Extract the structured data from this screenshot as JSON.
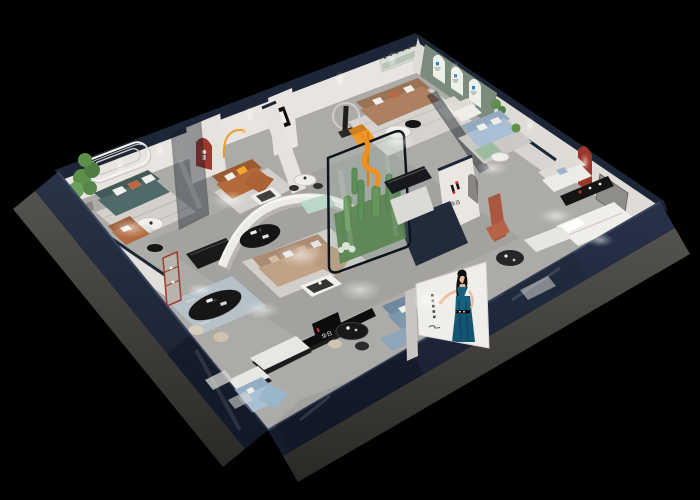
{
  "scene": {
    "type": "3d-isometric-cutaway-render",
    "setting": "furniture brand showroom interior at night on black background",
    "background_color": "#000000"
  },
  "brand": {
    "logo_mark": "stylized-H-black-red",
    "logo_text": "华日",
    "logo_black": "#151515",
    "logo_red": "#c92a26",
    "arch_logo_blue": "#2f7fc1"
  },
  "poster": {
    "subject": "woman in teal evening dress, arm extended",
    "background": "#f0eeea",
    "dress_color": "#19607e",
    "caption": "vertical caption marks"
  },
  "palette": {
    "background": "#000000",
    "fascia_navy": "#222c40",
    "wall_cap": "#1d2636",
    "slab_gray": "#4c4b49",
    "wall_light": "#e8e5e0",
    "wall_mid": "#dfdcd7",
    "wall_green": "#7b8c7c",
    "floor_light": "#adaba7",
    "floor_inlay_navy": "#222b3a",
    "rug_light": "#d3d0cb",
    "rug_blue": "#b7c3cc",
    "sofa_teal": "#4f6a68",
    "sofa_cognac": "#b36a3a",
    "sofa_tan": "#ad8061",
    "sofa_beige": "#c2a287",
    "sofa_blue": "#a9bfd3",
    "sofa_bluegray": "#7e98ab",
    "sofa_white": "#edebe6",
    "sofa_mint": "#bcd8c9",
    "sofa_skyblue": "#a6c0d4",
    "accent_orange": "#ef9a2e",
    "accent_terracotta": "#a9573f",
    "arch_red": "#9c372b",
    "plant_green": "#5d9048",
    "poster_bg": "#f0eeea",
    "dress_teal": "#19607e"
  },
  "rooms": [
    {
      "id": "left-lounge",
      "label": "teal sofa lounge with wall moulding"
    },
    {
      "id": "dining-nook",
      "label": "black oval dining table with stools"
    },
    {
      "id": "cognac-lounge",
      "label": "cognac leather sofa with red arch niche"
    },
    {
      "id": "tan-lounge",
      "label": "tan leather sofa room with statue and mirror"
    },
    {
      "id": "arch-gallery",
      "label": "sage wall with three arched niches"
    },
    {
      "id": "blue-lounge",
      "label": "light blue sofa room"
    },
    {
      "id": "white-bedroom",
      "label": "white sofa and bed display with red arch"
    },
    {
      "id": "center-lounge",
      "label": "curved partition lounge with beige sectional"
    },
    {
      "id": "cactus-garden",
      "label": "curved glass cactus garden"
    },
    {
      "id": "front-gallery",
      "label": "front display strip with benches and signage"
    }
  ]
}
